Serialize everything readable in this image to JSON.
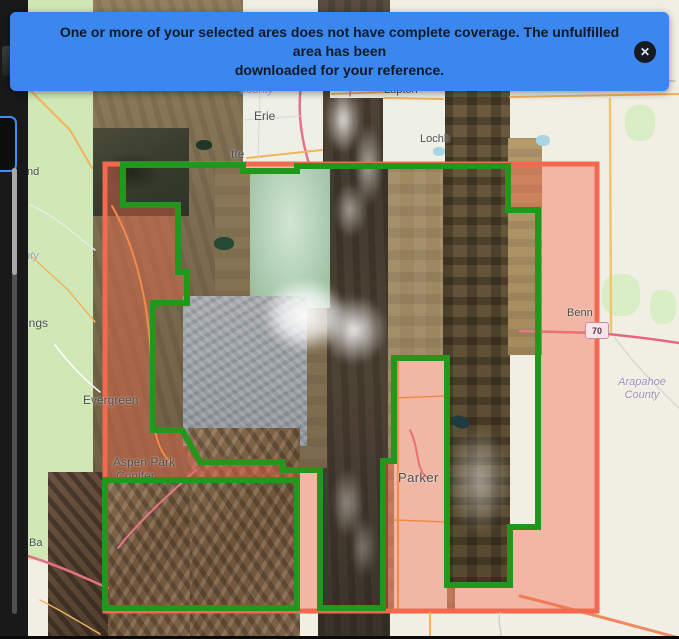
{
  "banner": {
    "message_line1": "One or more of your selected ares does not have complete coverage. The unfulfilled area has been",
    "message_line2": "downloaded for your reference.",
    "close_icon": "✕"
  },
  "map": {
    "labels": {
      "boulder_county": {
        "line1": "Boulder",
        "line2": "County"
      },
      "erie": "Erie",
      "lafayette_fragment": "tte",
      "frederick_fragment": "Fred",
      "lupton": "Lupton",
      "lochbuie_fragment": "Lochb",
      "bennett_fragment": "Benn",
      "i70": "70",
      "arapahoe_county": {
        "line1": "Arapahoe",
        "line2": "County"
      },
      "evergreen": "Evergreen",
      "aspen_park": "Aspen Park",
      "conifer": "Conifer",
      "parker": "Parker",
      "fragment_nd": "nd",
      "fragment_nty": "nty",
      "fragment_ings": "ings",
      "fragment_ba": "Ba"
    }
  },
  "colors": {
    "banner_bg": "#3a87ef",
    "banner_text": "#0e1a26",
    "sel_border": "#f3684e",
    "sel_fill": "#f26a4d",
    "aoi_green": "#23961c",
    "sidebar_bg": "#191919",
    "osm_green": "#cfe8b6",
    "osm_bg": "#f1efe4",
    "water": "#a9d4e2"
  }
}
